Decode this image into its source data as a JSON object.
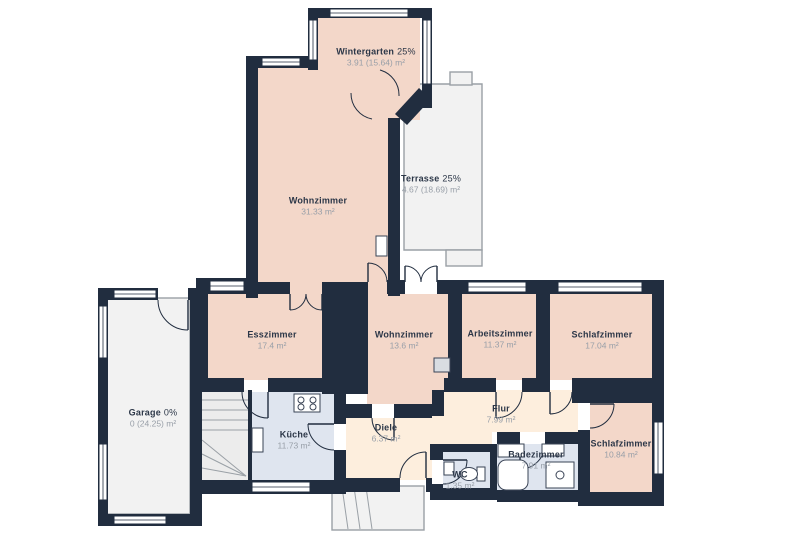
{
  "colors": {
    "wall": "#212d3f",
    "floor-living": "#f3d7c9",
    "floor-service": "#dfe5ef",
    "floor-hall": "#fdeedd",
    "floor-outdoor": "#f2f2f2",
    "line": "#9aa0a6",
    "label-name": "#2c3748",
    "label-area": "#989fa8",
    "page-bg": "#ffffff"
  },
  "rooms": {
    "wintergarten": {
      "name": "Wintergarten",
      "pct": "25%",
      "area": "3.91 (15.64) m²"
    },
    "wohnzimmer_gross": {
      "name": "Wohnzimmer",
      "pct": "",
      "area": "31.33 m²"
    },
    "terrasse": {
      "name": "Terrasse",
      "pct": "25%",
      "area": "4.67 (18.69) m²"
    },
    "esszimmer": {
      "name": "Esszimmer",
      "pct": "",
      "area": "17.4 m²"
    },
    "wohnzimmer_klein": {
      "name": "Wohnzimmer",
      "pct": "",
      "area": "13.6 m²"
    },
    "arbeitszimmer": {
      "name": "Arbeitszimmer",
      "pct": "",
      "area": "11.37 m²"
    },
    "schlafzimmer_gross": {
      "name": "Schlafzimmer",
      "pct": "",
      "area": "17.04 m²"
    },
    "garage": {
      "name": "Garage",
      "pct": "0%",
      "area": "0 (24.25) m²"
    },
    "kueche": {
      "name": "Küche",
      "pct": "",
      "area": "11.73 m²"
    },
    "diele": {
      "name": "Diele",
      "pct": "",
      "area": "6.37 m²"
    },
    "flur": {
      "name": "Flur",
      "pct": "",
      "area": "7.99 m²"
    },
    "badezimmer": {
      "name": "Badezimmer",
      "pct": "",
      "area": "7.91 m²"
    },
    "wc": {
      "name": "WC",
      "pct": "",
      "area": "1.35 m²"
    },
    "schlafzimmer_klein": {
      "name": "Schlafzimmer",
      "pct": "",
      "area": "10.84 m²"
    }
  }
}
